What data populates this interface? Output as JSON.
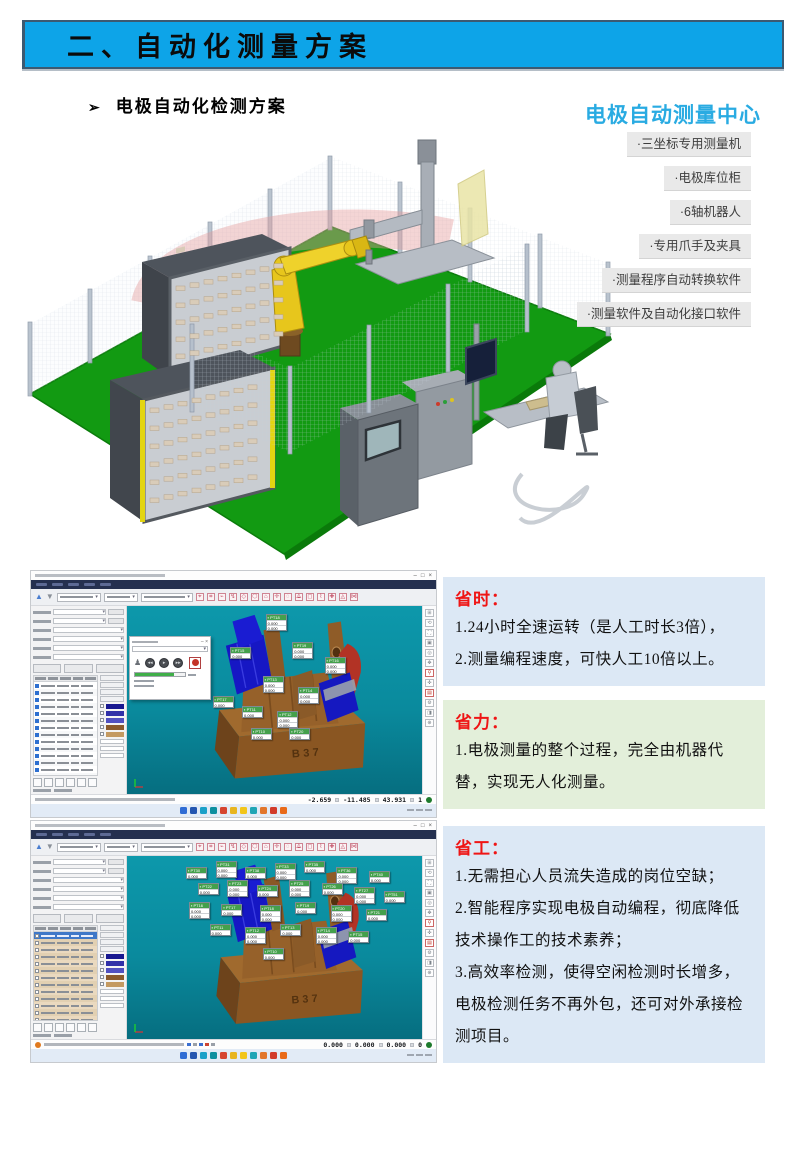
{
  "banner": {
    "text": "二、自动化测量方案",
    "bg_color": "#0da4e8"
  },
  "subheading": {
    "bullet": "➢",
    "text": "电极自动化检测方案"
  },
  "center": {
    "title": "电极自动测量中心",
    "title_color": "#29abe2",
    "items": [
      "·三坐标专用测量机",
      "·电极库位柜",
      "·6轴机器人",
      "·专用爪手及夹具",
      "·测量程序自动转换软件",
      "·测量软件及自动化接口软件"
    ]
  },
  "scene": {
    "description": "电极自动测量中心三维布局图",
    "floor_color": "#129a12",
    "robot_color": "#e7c61c"
  },
  "benefits": [
    {
      "title": "省时：",
      "tone": "blue",
      "items": [
        "1.24小时全速运转（是人工时长3倍），",
        "2.测量编程速度，可快人工10倍以上。"
      ]
    },
    {
      "title": "省力：",
      "tone": "green",
      "items": [
        "1.电极测量的整个过程，完全由机器代替，实现无人化测量。"
      ]
    },
    {
      "title": "省工：",
      "tone": "blue",
      "items": [
        "1.无需担心人员流失造成的岗位空缺；",
        "2.智能程序实现电极自动编程，彻底降低技术操作工的技术素养；",
        "3.高效率检测，使得空闲检测时长增多，电极检测任务不再外包，还可对外承接检测项目。"
      ]
    }
  ],
  "shots": {
    "window_controls": [
      "–",
      "□",
      "×"
    ],
    "viewport_color": "#0a8a9d",
    "tag_header_color": "#44a04c",
    "progress_color": "#3fae49",
    "taskbar_icon_colors": [
      "#2f6cd4",
      "#2456b0",
      "#1aa0c8",
      "#0d8f9f",
      "#d6452f",
      "#e8b51f",
      "#f2c51a",
      "#1fa5b5",
      "#e2762b",
      "#d23b2a",
      "#e96a18"
    ],
    "top": {
      "model_label": "B37",
      "status": {
        "x": "-2.659",
        "y": "-11.485",
        "z": "43.931",
        "count": "1"
      },
      "table_rows": 15,
      "tags": [
        {
          "label": "PT18",
          "x": 47,
          "y": 4,
          "rows": [
            "0.000",
            "0.000"
          ]
        },
        {
          "label": "PT15",
          "x": 35,
          "y": 22,
          "rows": [
            "0.000"
          ]
        },
        {
          "label": "PT19",
          "x": 56,
          "y": 19,
          "rows": [
            "0.000",
            "0.000"
          ]
        },
        {
          "label": "PT16",
          "x": 67,
          "y": 27,
          "rows": [
            "0.000",
            "0.000"
          ]
        },
        {
          "label": "PT13",
          "x": 46,
          "y": 37,
          "rows": [
            "0.000",
            "0.000"
          ]
        },
        {
          "label": "PT17",
          "x": 29,
          "y": 48,
          "rows": [
            "0.000"
          ]
        },
        {
          "label": "PT14",
          "x": 58,
          "y": 43,
          "rows": [
            "0.000",
            "0.000"
          ]
        },
        {
          "label": "PT11",
          "x": 39,
          "y": 53,
          "rows": [
            "0.000"
          ]
        },
        {
          "label": "PT12",
          "x": 51,
          "y": 56,
          "rows": [
            "0.000",
            "0.000"
          ]
        },
        {
          "label": "PT10",
          "x": 42,
          "y": 65,
          "rows": [
            "0.000"
          ]
        },
        {
          "label": "PT20",
          "x": 55,
          "y": 65,
          "rows": [
            "0.000"
          ]
        }
      ]
    },
    "bottom": {
      "model_label": "B37",
      "status": {
        "x": "0.000",
        "y": "0.000",
        "z": "0.000",
        "count": "0"
      },
      "table_rows": 16,
      "tags": [
        {
          "label": "PT30",
          "x": 20,
          "y": 6,
          "rows": [
            "0.000"
          ]
        },
        {
          "label": "PT31",
          "x": 30,
          "y": 3,
          "rows": [
            "0.000",
            "0.000"
          ]
        },
        {
          "label": "PT38",
          "x": 40,
          "y": 6,
          "rows": [
            "0.000"
          ]
        },
        {
          "label": "PT33",
          "x": 50,
          "y": 4,
          "rows": [
            "0.000",
            "0.000"
          ]
        },
        {
          "label": "PT35",
          "x": 60,
          "y": 3,
          "rows": [
            "0.000"
          ]
        },
        {
          "label": "PT36",
          "x": 71,
          "y": 6,
          "rows": [
            "0.000",
            "0.000"
          ]
        },
        {
          "label": "PT40",
          "x": 82,
          "y": 8,
          "rows": [
            "0.000"
          ]
        },
        {
          "label": "PT22",
          "x": 24,
          "y": 15,
          "rows": [
            "0.000"
          ]
        },
        {
          "label": "PT23",
          "x": 34,
          "y": 13,
          "rows": [
            "0.000",
            "0.000"
          ]
        },
        {
          "label": "PT24",
          "x": 44,
          "y": 16,
          "rows": [
            "0.000"
          ]
        },
        {
          "label": "PT25",
          "x": 55,
          "y": 13,
          "rows": [
            "0.000",
            "0.000"
          ]
        },
        {
          "label": "PT26",
          "x": 66,
          "y": 15,
          "rows": [
            "0.000"
          ]
        },
        {
          "label": "PT27",
          "x": 77,
          "y": 17,
          "rows": [
            "0.000",
            "0.000"
          ]
        },
        {
          "label": "PT51",
          "x": 87,
          "y": 19,
          "rows": [
            "0.000"
          ]
        },
        {
          "label": "PT16",
          "x": 21,
          "y": 25,
          "rows": [
            "0.000",
            "0.000"
          ]
        },
        {
          "label": "PT17",
          "x": 32,
          "y": 26,
          "rows": [
            "0.000"
          ]
        },
        {
          "label": "PT18",
          "x": 45,
          "y": 27,
          "rows": [
            "0.000",
            "0.000"
          ]
        },
        {
          "label": "PT19",
          "x": 57,
          "y": 25,
          "rows": [
            "0.000"
          ]
        },
        {
          "label": "PT20",
          "x": 69,
          "y": 27,
          "rows": [
            "0.000",
            "0.000"
          ]
        },
        {
          "label": "PT21",
          "x": 81,
          "y": 29,
          "rows": [
            "0.000"
          ]
        },
        {
          "label": "PT11",
          "x": 28,
          "y": 37,
          "rows": [
            "0.000"
          ]
        },
        {
          "label": "PT12",
          "x": 40,
          "y": 39,
          "rows": [
            "0.000",
            "0.000"
          ]
        },
        {
          "label": "PT13",
          "x": 52,
          "y": 37,
          "rows": [
            "0.000"
          ]
        },
        {
          "label": "PT14",
          "x": 64,
          "y": 39,
          "rows": [
            "0.000",
            "0.000"
          ]
        },
        {
          "label": "PT15",
          "x": 75,
          "y": 41,
          "rows": [
            "0.000"
          ]
        },
        {
          "label": "PT10",
          "x": 46,
          "y": 50,
          "rows": [
            "0.000"
          ]
        }
      ]
    }
  }
}
